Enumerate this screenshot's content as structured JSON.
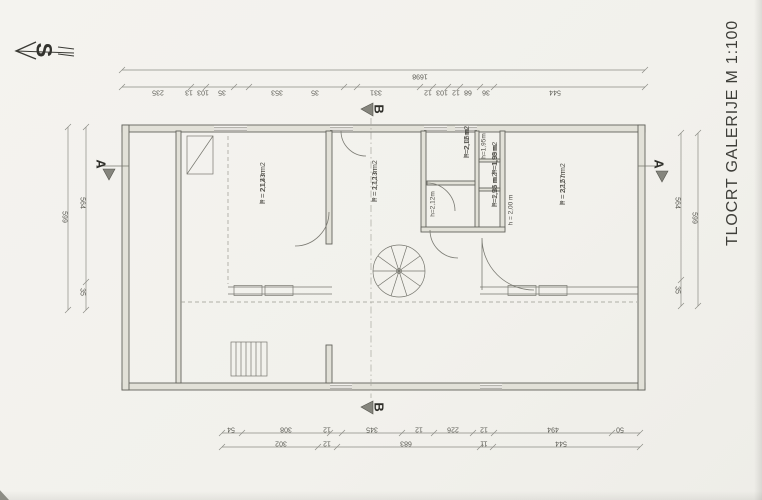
{
  "title": "TLOCRT GALERIJE  M 1:100",
  "north": {
    "label": "S"
  },
  "sections": {
    "a_left": "A",
    "a_right": "A",
    "b_top": "B",
    "b_bottom": "B"
  },
  "dims": {
    "top_total": {
      "text": "1698",
      "x": 420,
      "y": 76
    },
    "top_segments": [
      {
        "text": "235",
        "x": 158,
        "y": 92
      },
      {
        "text": "13",
        "x": 189,
        "y": 92
      },
      {
        "text": "103",
        "x": 203,
        "y": 92
      },
      {
        "text": "35",
        "x": 222,
        "y": 92
      },
      {
        "text": "353",
        "x": 277,
        "y": 92
      },
      {
        "text": "35",
        "x": 315,
        "y": 92
      },
      {
        "text": "331",
        "x": 376,
        "y": 92
      },
      {
        "text": "12",
        "x": 428,
        "y": 92
      },
      {
        "text": "103",
        "x": 442,
        "y": 92
      },
      {
        "text": "12",
        "x": 456,
        "y": 92
      },
      {
        "text": "68",
        "x": 468,
        "y": 92
      },
      {
        "text": "36",
        "x": 486,
        "y": 92
      },
      {
        "text": "544",
        "x": 555,
        "y": 92
      }
    ],
    "bottom_upper": [
      {
        "text": "54",
        "x": 231,
        "y": 429
      },
      {
        "text": "308",
        "x": 286,
        "y": 429
      },
      {
        "text": "12",
        "x": 327,
        "y": 429
      },
      {
        "text": "345",
        "x": 372,
        "y": 429
      },
      {
        "text": "12",
        "x": 419,
        "y": 429
      },
      {
        "text": "226",
        "x": 453,
        "y": 429
      },
      {
        "text": "12",
        "x": 484,
        "y": 429
      },
      {
        "text": "494",
        "x": 553,
        "y": 429
      },
      {
        "text": "50",
        "x": 620,
        "y": 429
      }
    ],
    "bottom_lower": [
      {
        "text": "302",
        "x": 281,
        "y": 443
      },
      {
        "text": "12",
        "x": 327,
        "y": 443
      },
      {
        "text": "683",
        "x": 406,
        "y": 443
      },
      {
        "text": "11",
        "x": 484,
        "y": 443
      },
      {
        "text": "544",
        "x": 561,
        "y": 443
      }
    ],
    "left": [
      {
        "text": "599",
        "x": 64,
        "y": 217
      },
      {
        "text": "564",
        "x": 82,
        "y": 203
      },
      {
        "text": "35",
        "x": 82,
        "y": 292
      }
    ],
    "right": [
      {
        "text": "599",
        "x": 694,
        "y": 218
      },
      {
        "text": "564",
        "x": 677,
        "y": 203
      },
      {
        "text": "35",
        "x": 677,
        "y": 290
      }
    ]
  },
  "rooms": [
    {
      "area": "P = 21,43 m2",
      "height": "h = 2,12 m",
      "x": 259,
      "y": 204
    },
    {
      "area": "P = 17,13 m2",
      "height": "h = 2,12 m",
      "x": 371,
      "y": 202
    },
    {
      "area": "P = 32,57 m2",
      "height": "h = 2,12 m",
      "x": 559,
      "y": 205
    },
    {
      "area": "P=2,06m2",
      "height": "h=2,12 m",
      "x": 463,
      "y": 158
    },
    {
      "area": "P=1,99m2",
      "height": "h=1,98 m",
      "x": 491,
      "y": 174
    },
    {
      "area": "P=2,35 m2",
      "height": "h=1,98 m",
      "x": 491,
      "y": 207
    }
  ],
  "height_labels": [
    {
      "text": "h=1,95m",
      "x": 484,
      "y": 146
    },
    {
      "text": "h=2,12m",
      "x": 433,
      "y": 204
    },
    {
      "text": "h = 2,00 m",
      "x": 511,
      "y": 210
    }
  ]
}
